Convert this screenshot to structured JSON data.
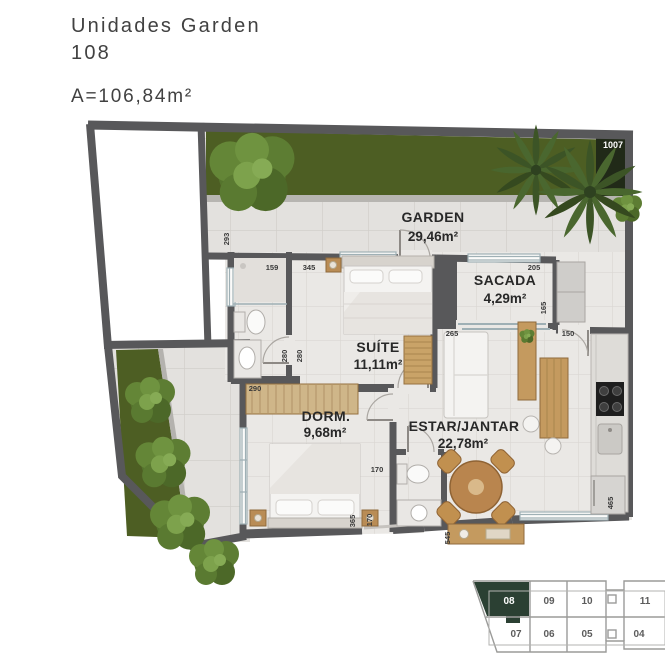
{
  "header": {
    "title": "Unidades Garden\n108",
    "area": "A=106,84m²"
  },
  "plan": {
    "external_unit_label": "1007",
    "rooms": [
      {
        "name": "GARDEN",
        "area": "29,46m²"
      },
      {
        "name": "SACADA",
        "area": "4,29m²"
      },
      {
        "name": "SUÍTE",
        "area": "11,11m²"
      },
      {
        "name": "DORM.",
        "area": "9,68m²"
      },
      {
        "name": "ESTAR/JANTAR",
        "area": "22,78m²"
      }
    ],
    "dimensions": [
      "293",
      "159",
      "345",
      "280",
      "280",
      "290",
      "205",
      "165",
      "150",
      "265",
      "170",
      "365",
      "170",
      "545",
      "465"
    ]
  },
  "unit_selector": {
    "selected_unit": "08",
    "rows": [
      [
        "08",
        "09",
        "10",
        "11"
      ],
      [
        "07",
        "06",
        "05",
        "04"
      ]
    ]
  },
  "colors": {
    "selected_unit_fill": "#2b4033",
    "grass": "#4d5e23",
    "wall": "#58585a",
    "wood": "#c49a5f"
  }
}
